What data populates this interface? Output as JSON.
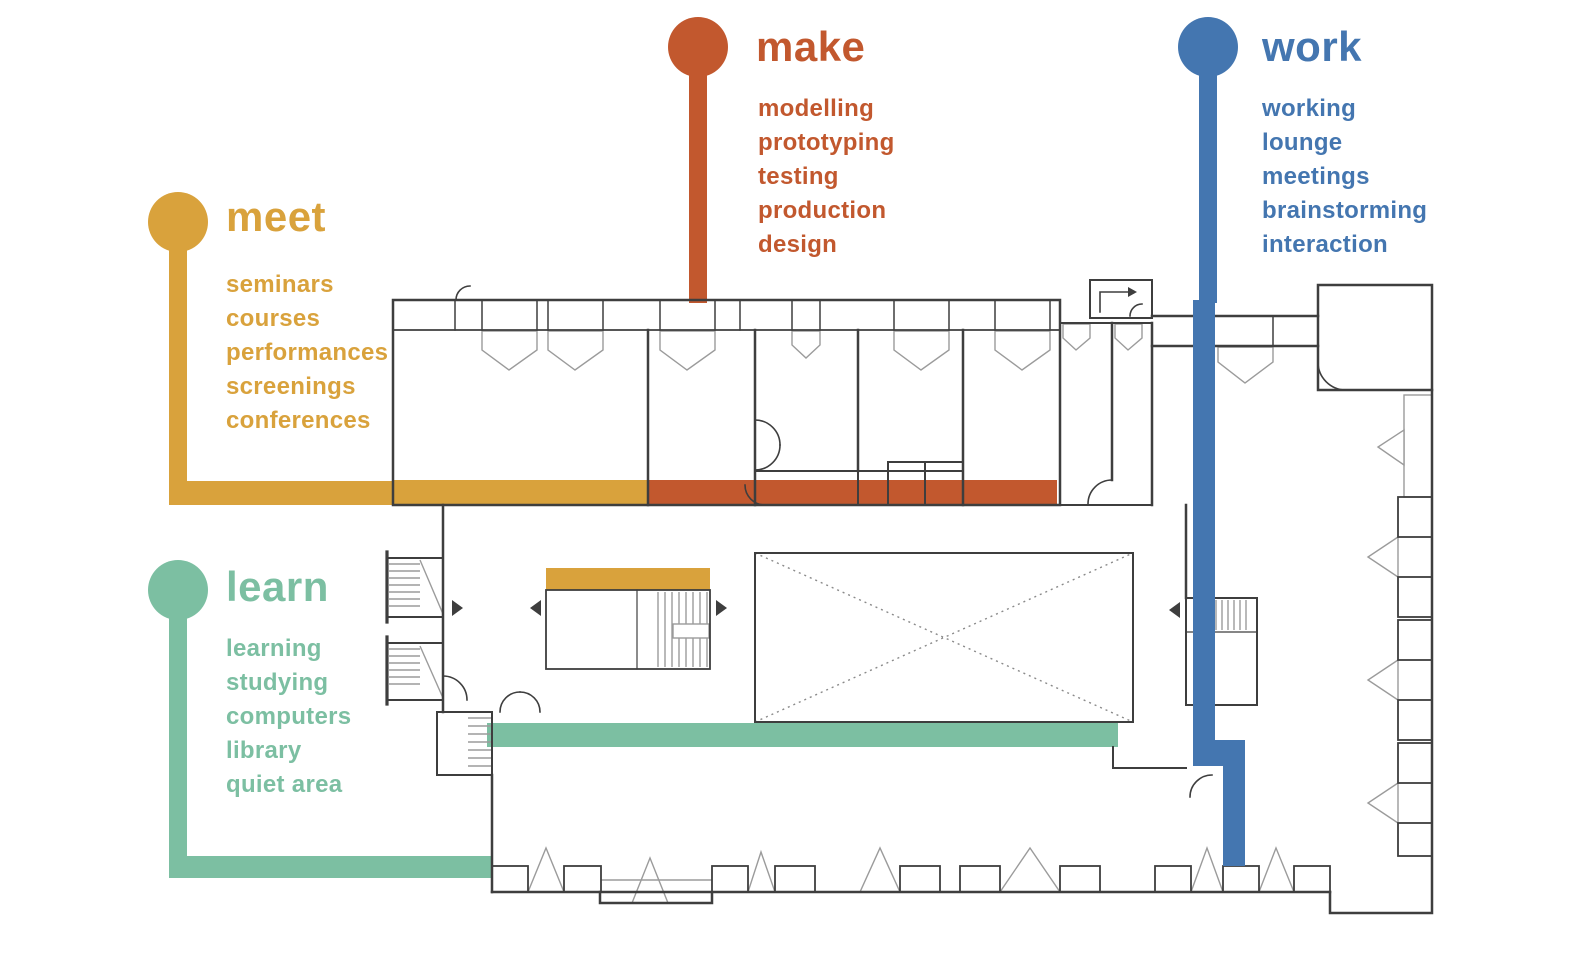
{
  "poster": {
    "background": "#ffffff"
  },
  "legend": {
    "meet": {
      "title": "meet",
      "color": "#D9A23C",
      "items": [
        "seminars",
        "courses",
        "performances",
        "screenings",
        "conferences"
      ]
    },
    "make": {
      "title": "make",
      "color": "#C2582E",
      "items": [
        "modelling",
        "prototyping",
        "testing",
        "production",
        "design"
      ]
    },
    "learn": {
      "title": "learn",
      "color": "#7CBFA2",
      "items": [
        "learning",
        "studying",
        "computers",
        "library",
        "quiet area"
      ]
    },
    "work": {
      "title": "work",
      "color": "#4476B0",
      "items": [
        "working",
        "lounge",
        "meetings",
        "brainstorming",
        "interaction"
      ]
    }
  },
  "plan_colors": {
    "wall": "#3E3E3E",
    "light_line": "#9B9B9B",
    "meet_band": "#D9A23C",
    "make_band": "#C2582E",
    "learn_band": "#7CBFA2",
    "work_path": "#4476B0"
  }
}
